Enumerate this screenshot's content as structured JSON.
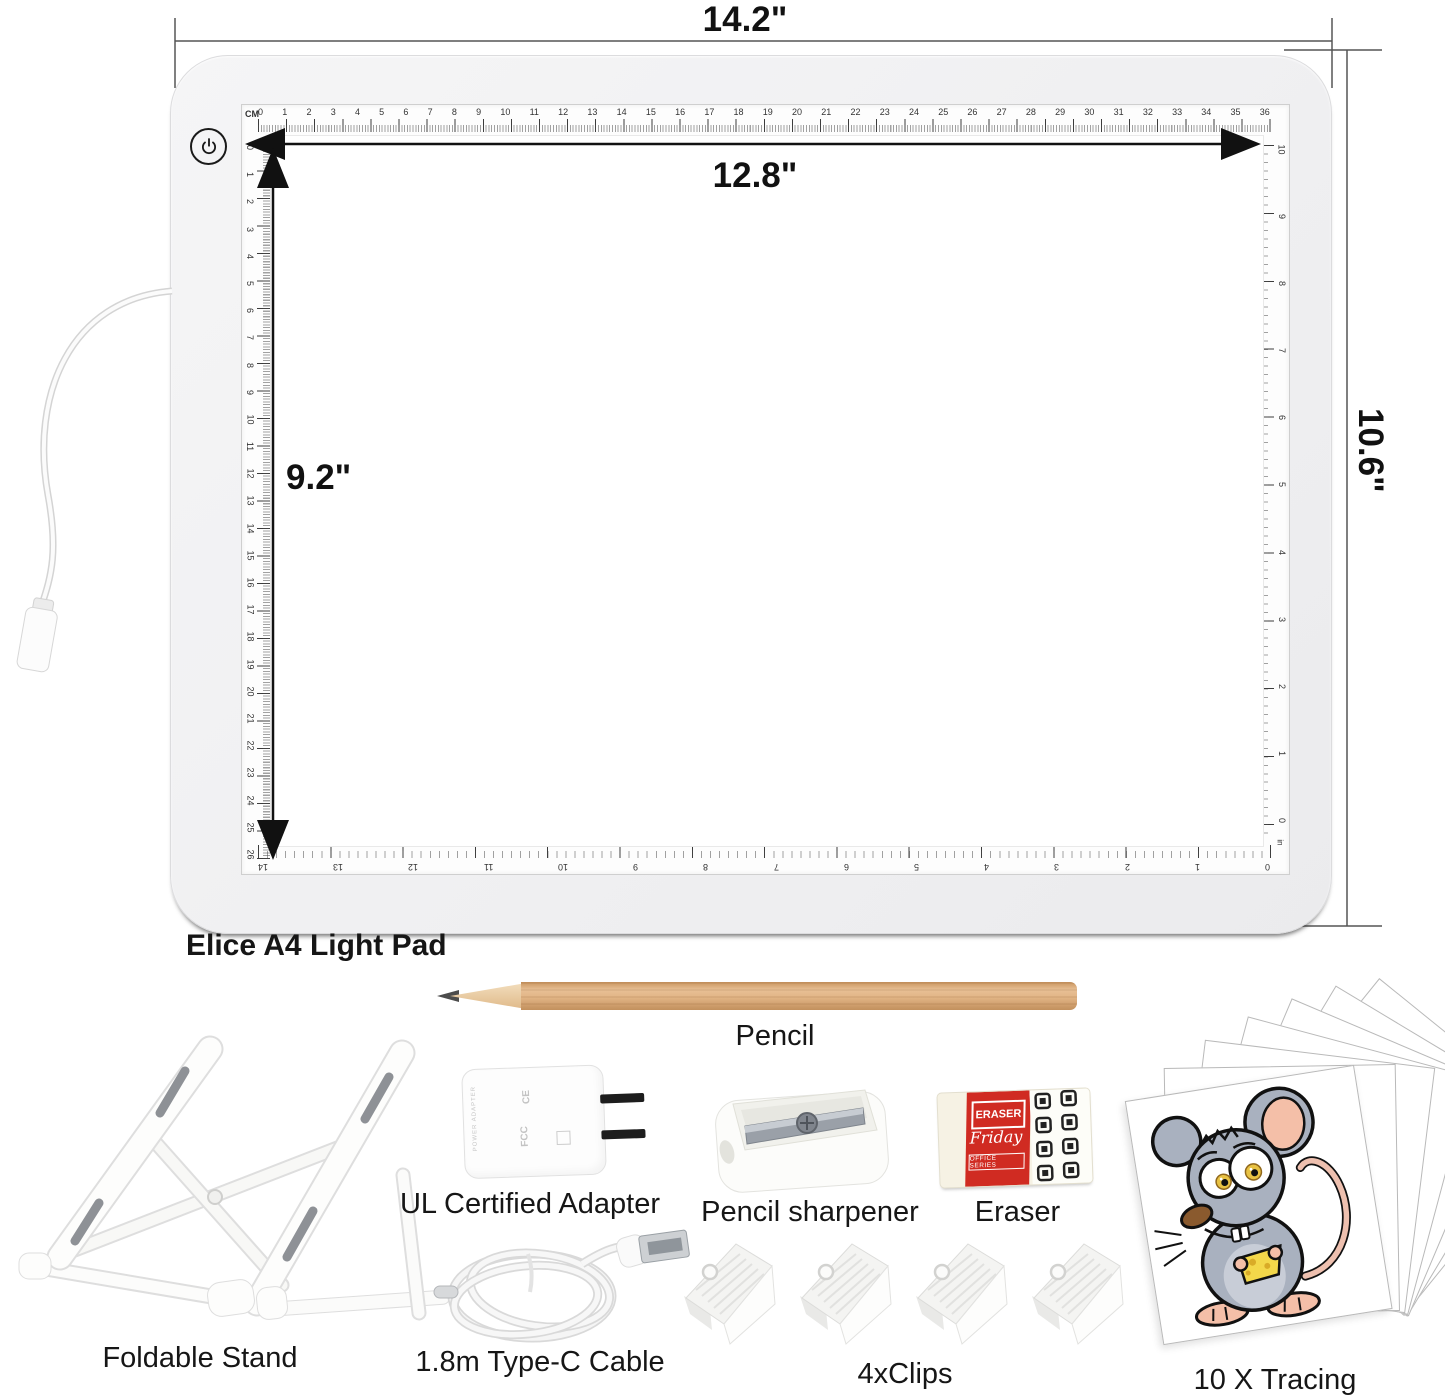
{
  "product": {
    "name": "Elice A4 Light Pad"
  },
  "dimensions": {
    "outer_width": "14.2\"",
    "inner_width": "12.8\"",
    "inner_height": "9.2\"",
    "outer_height": "10.6\""
  },
  "pad": {
    "ruler_unit": "CM",
    "right_unit": "in",
    "top_ruler_cm": [
      "0",
      "1",
      "2",
      "3",
      "4",
      "5",
      "6",
      "7",
      "8",
      "9",
      "10",
      "11",
      "12",
      "13",
      "14",
      "15",
      "16",
      "17",
      "18",
      "19",
      "20",
      "21",
      "22",
      "23",
      "24",
      "25",
      "26",
      "27",
      "28",
      "29",
      "30",
      "31",
      "32",
      "33",
      "34",
      "35",
      "36"
    ],
    "left_ruler_cm": [
      "0",
      "1",
      "2",
      "3",
      "4",
      "5",
      "6",
      "7",
      "8",
      "9",
      "10",
      "11",
      "12",
      "13",
      "14",
      "15",
      "16",
      "17",
      "18",
      "19",
      "20",
      "21",
      "22",
      "23",
      "24",
      "25",
      "26"
    ],
    "right_ruler_in": [
      "10",
      "9",
      "8",
      "7",
      "6",
      "5",
      "4",
      "3",
      "2",
      "1",
      "0"
    ],
    "bottom_ruler_in": [
      "14",
      "13",
      "12",
      "11",
      "10",
      "9",
      "8",
      "7",
      "6",
      "5",
      "4",
      "3",
      "2",
      "1",
      "0"
    ]
  },
  "labels": {
    "pencil": "Pencil",
    "stand": "Foldable Stand",
    "adapter": "UL Certified Adapter",
    "sharpener": "Pencil sharpener",
    "eraser": "Eraser",
    "cable": "1.8m Type-C Cable",
    "clips": "4xClips",
    "papers": "10 X Tracing Papers"
  },
  "eraser_brand": {
    "title": "ERASER",
    "script": "Friday",
    "series": "OFFICE SERIES"
  },
  "adapter_print": {
    "side_text": "POWER ADAPTER",
    "marks": [
      "CE",
      "FCC"
    ]
  },
  "colors": {
    "dimension_ink": "#111111",
    "pad_body": "#f1f1f2",
    "pencil_wood": "#dca87c",
    "eraser_red": "#d02b22",
    "cheese_yellow": "#f3d74a",
    "mouse_gray": "#a9b1bf",
    "ear_pink": "#f4bfa8"
  }
}
